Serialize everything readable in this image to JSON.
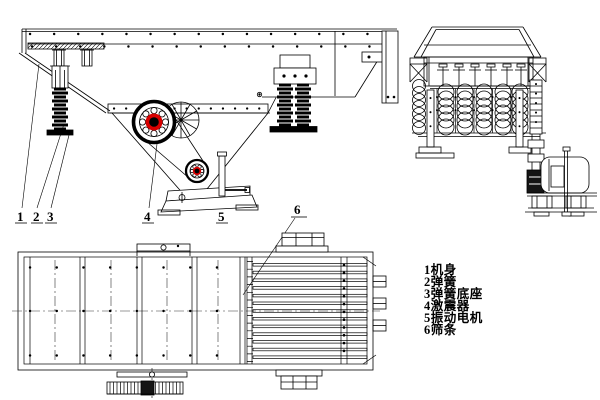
{
  "colors": {
    "background": "#ffffff",
    "ink": "#000000",
    "red_accent": "#d90000"
  },
  "legend": {
    "items": [
      {
        "text": "1机身"
      },
      {
        "text": "2弹簧"
      },
      {
        "text": "3弹簧底座"
      },
      {
        "text": "4激震器"
      },
      {
        "text": "5振动电机"
      },
      {
        "text": "6筛条"
      }
    ]
  },
  "callouts": {
    "c1": "1",
    "c2": "2",
    "c3": "3",
    "c4": "4",
    "c5": "5",
    "c6": "6"
  }
}
